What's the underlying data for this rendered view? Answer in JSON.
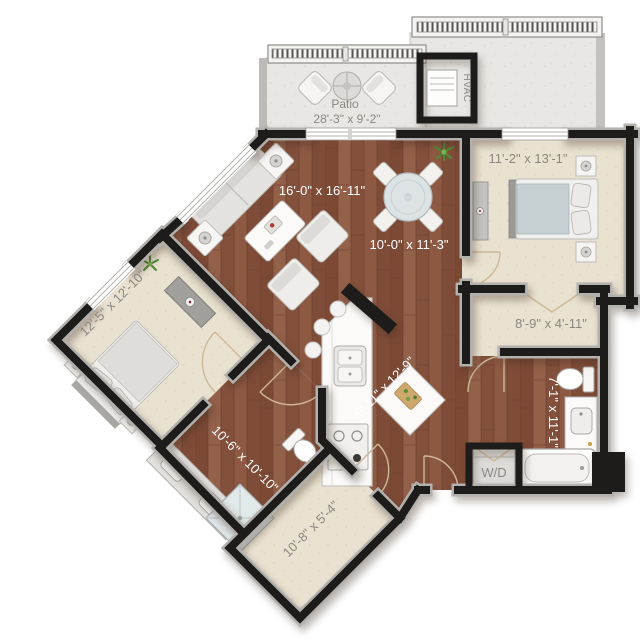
{
  "rooms": {
    "living": {
      "dims": "16'-0\" x 16'-11\""
    },
    "dining": {
      "dims": "10'-0\" x 11'-3\""
    },
    "kitchen": {
      "dims": "9'-11\" x 12'-9\""
    },
    "primary_bedroom": {
      "dims": "11'-2\" x 13'-1\""
    },
    "second_bedroom": {
      "dims": "12'-5\" x 12'-10\""
    },
    "primary_bath": {
      "dims": "7'-1\" x 11'-1\""
    },
    "second_bath": {
      "dims": "10'-6\" x 10'-10\""
    },
    "walk_in_closet": {
      "dims": "10'-8\" x 5'-4\""
    },
    "bedroom_closet": {
      "dims": "8'-9\" x 4'-11\""
    },
    "patio": {
      "name": "Patio",
      "dims": "28'-3\" x 9'-2\""
    }
  },
  "equipment": {
    "hvac": "HVAC",
    "washer_dryer": "W/D"
  },
  "colors": {
    "wood": "#8a5640",
    "carpet": "#eae2d1",
    "concrete": "#e8e7e4",
    "wall": "#1d1c1a",
    "label_on_wood": "#ffffff",
    "label_on_carpet": "#8b8680",
    "door_arc": "#cdb897"
  }
}
